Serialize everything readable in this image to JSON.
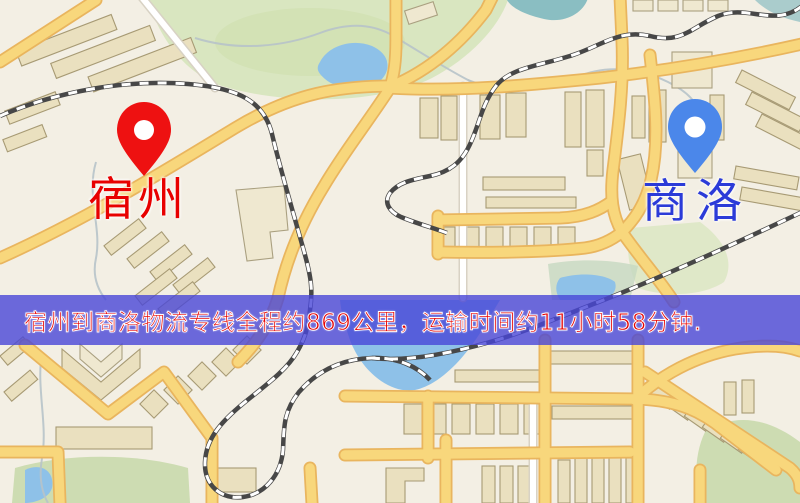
{
  "banner": {
    "text": "宿州到商洛物流专线全程约869公里，运输时间约11小时58分钟.",
    "distance_km": "869",
    "duration_hours": "11",
    "duration_minutes": "58",
    "background_color": "rgba(72,70,215,0.8)",
    "text_color": "#e60000"
  },
  "markers": {
    "origin": {
      "label": "宿州",
      "icon": "map-pin-icon",
      "pin_color": "#ee1111",
      "label_color": "#e80000"
    },
    "destination": {
      "label": "商洛",
      "icon": "map-pin-icon",
      "pin_color": "#4b87ea",
      "label_color": "#2b3bd8"
    }
  },
  "map_style": {
    "background": "#f3efe4",
    "road_primary": "#f8d77c",
    "road_casing": "#e9b55e",
    "road_secondary": "#ffffff",
    "park": "#d9e6c0",
    "water": "#8ec1e8",
    "building": "#eae0bf",
    "railway": "#474747",
    "pin_hole": "#ffffff"
  }
}
